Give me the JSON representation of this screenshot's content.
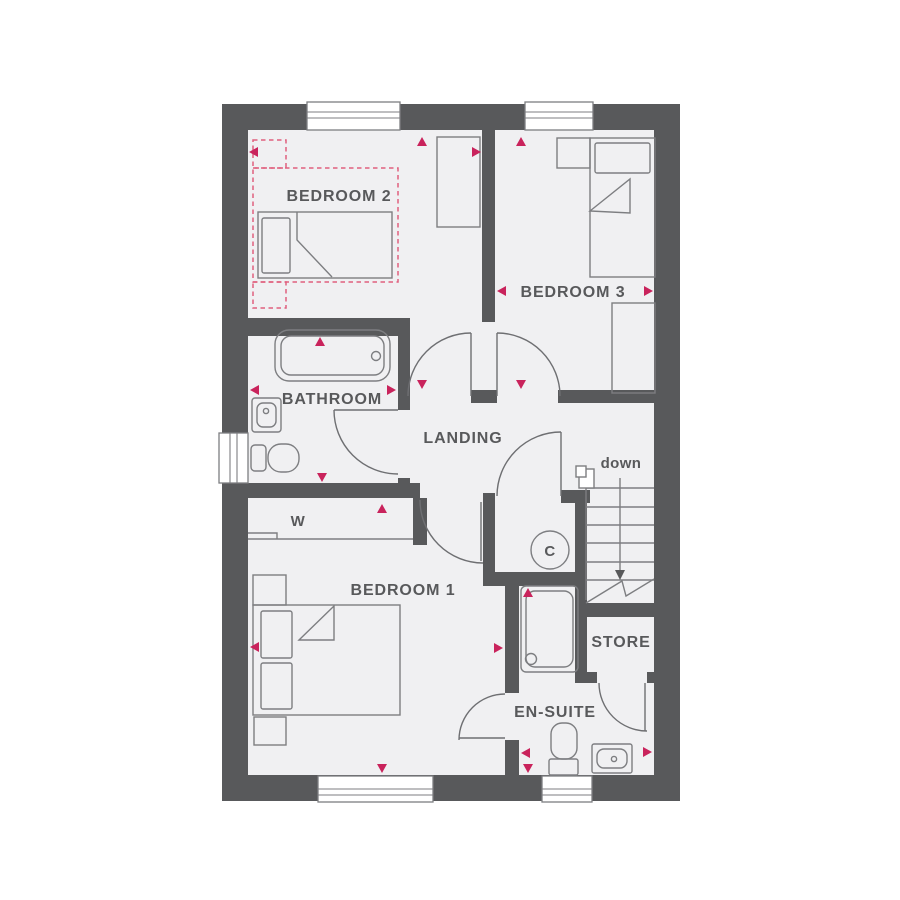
{
  "colors": {
    "background": "#ffffff",
    "wall": "#58595b",
    "floor": "#f0f0f2",
    "line": "#7d7e81",
    "door": "#6e6f72",
    "text": "#58595b",
    "marker": "#c9235c",
    "dashed": "#e0607e",
    "window": "#ffffff"
  },
  "rooms": {
    "bedroom2": {
      "label": "BEDROOM 2"
    },
    "bedroom3": {
      "label": "BEDROOM 3"
    },
    "bathroom": {
      "label": "BATHROOM"
    },
    "landing": {
      "label": "LANDING"
    },
    "bedroom1": {
      "label": "BEDROOM 1"
    },
    "ensuite": {
      "label": "EN-SUITE"
    },
    "store": {
      "label": "STORE"
    },
    "wardrobe": {
      "label": "W"
    },
    "cupboard": {
      "label": "C"
    }
  },
  "stairs": {
    "direction_label": "down"
  }
}
